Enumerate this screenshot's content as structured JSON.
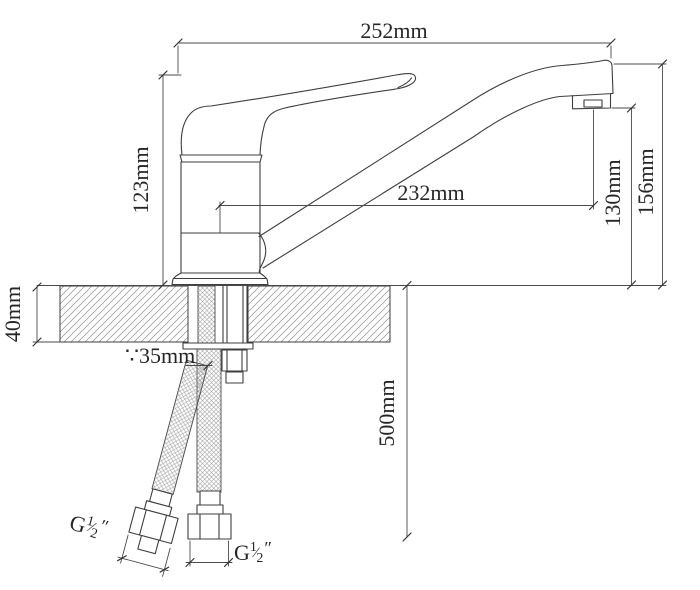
{
  "drawing": {
    "type": "faucet-installation-technical-drawing",
    "background": "#ffffff",
    "line_color": "#3e3e3e",
    "hatch_color": "#8f8f8f",
    "braid_color": "#9e9e9e"
  },
  "dimensions": {
    "overall_width": "252mm",
    "body_height": "123mm",
    "spout_reach": "232mm",
    "outlet_height": "130mm",
    "spout_height": "156mm",
    "deck_thickness": "40mm",
    "hole_diameter": "∵35mm",
    "hose_length": "500mm"
  },
  "thread_labels": {
    "left": {
      "prefix": "G",
      "numerator": "1",
      "slash": "⁄",
      "denominator": "2",
      "unit": "″"
    },
    "right": {
      "prefix": "G",
      "numerator": "1",
      "slash": "⁄",
      "denominator": "2",
      "unit": "″"
    }
  }
}
